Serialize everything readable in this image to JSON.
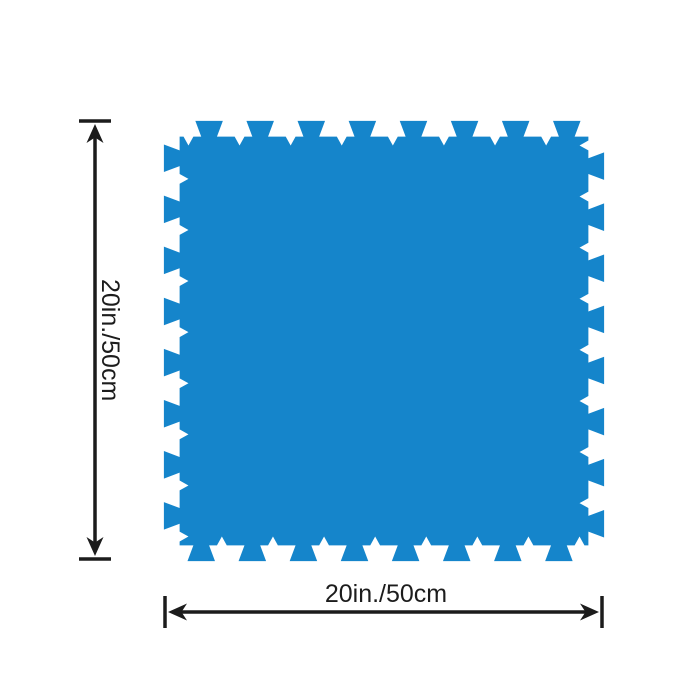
{
  "colors": {
    "mat_blue": "#1585CB",
    "dimension_black": "#1c1c1c"
  },
  "product": {
    "item_name": "interlocking-foam-floor-mat"
  },
  "dimensions": {
    "height": {
      "label": "20in./50cm"
    },
    "width": {
      "label": "20in./50cm"
    }
  }
}
